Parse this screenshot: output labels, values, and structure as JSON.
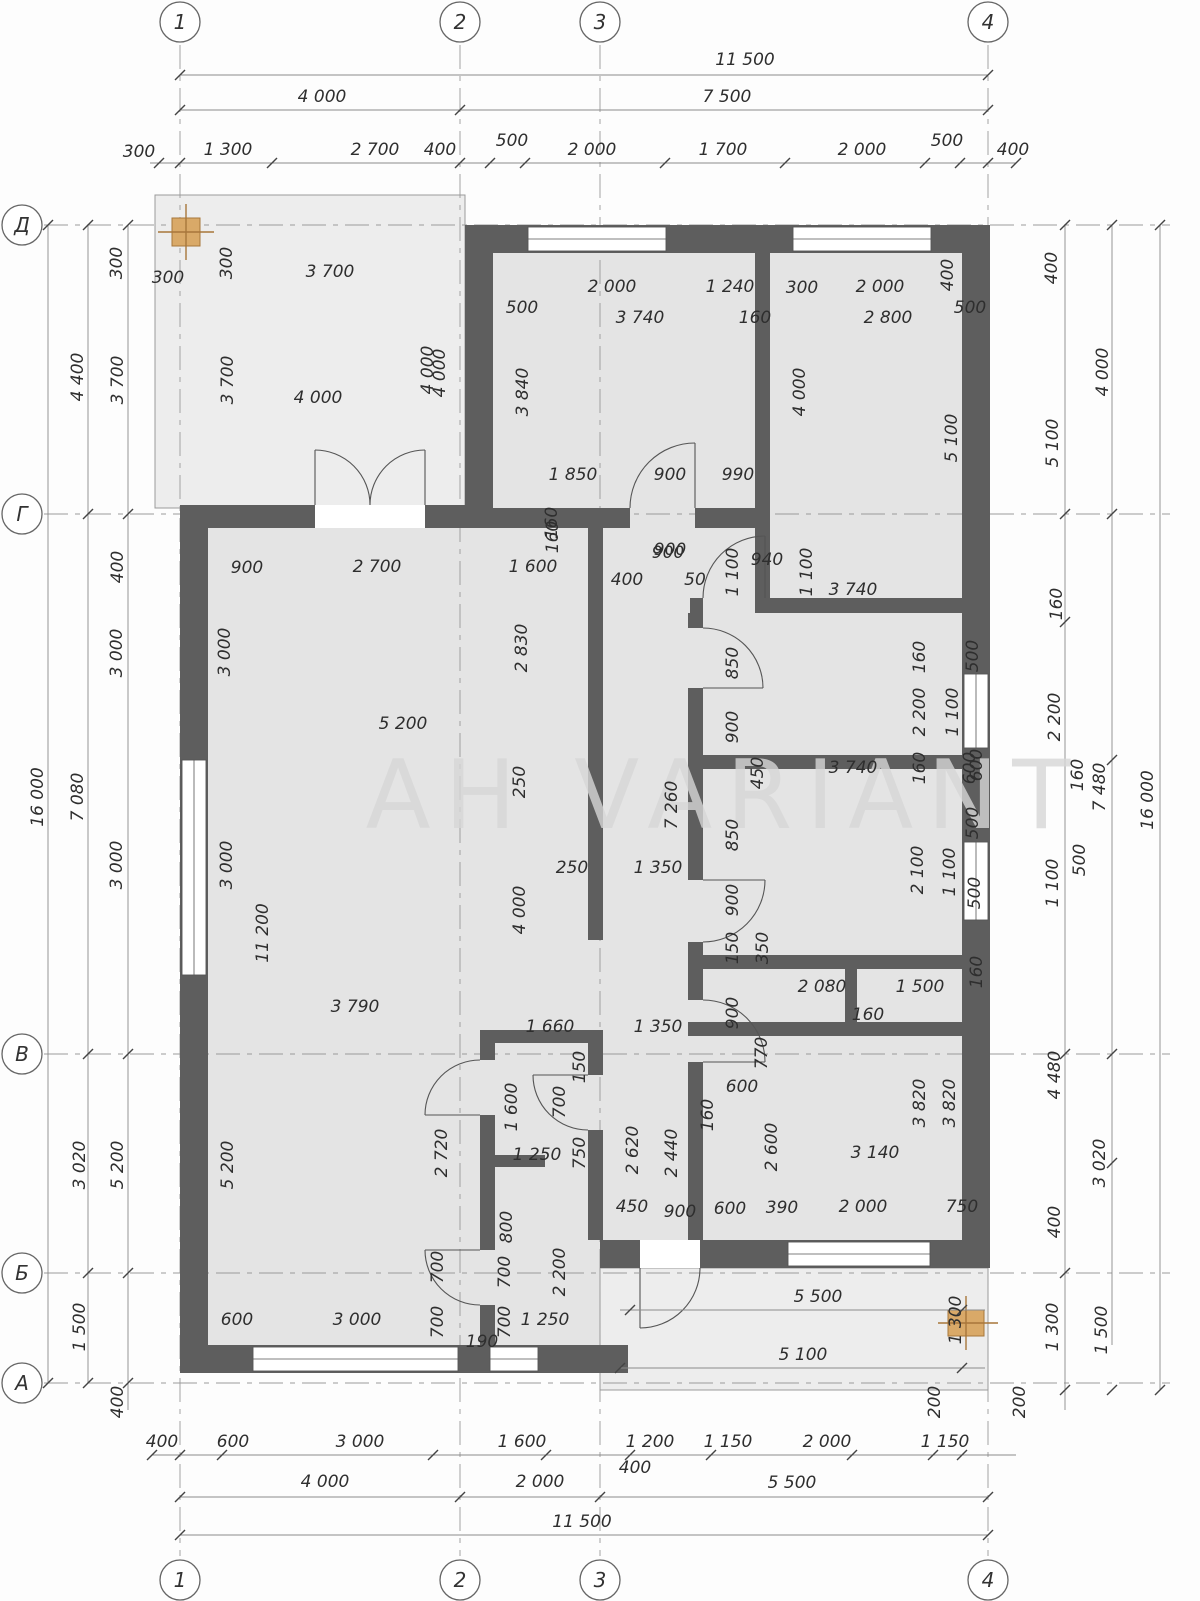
{
  "plan": {
    "watermark": "АН VARIANT",
    "overall": {
      "width_mm": "11 500",
      "height_mm": "16 000"
    },
    "grid_axes": {
      "columns": [
        {
          "label": "1",
          "x": 180
        },
        {
          "label": "2",
          "x": 460
        },
        {
          "label": "3",
          "x": 600
        },
        {
          "label": "4",
          "x": 988
        }
      ],
      "rows": [
        {
          "label": "Д",
          "y": 225
        },
        {
          "label": "Г",
          "y": 514
        },
        {
          "label": "В",
          "y": 1054
        },
        {
          "label": "Б",
          "y": 1273
        },
        {
          "label": "А",
          "y": 1383
        }
      ]
    },
    "dim_labels": [
      [
        745,
        60,
        0,
        "11 500"
      ],
      [
        322,
        97,
        0,
        "4 000"
      ],
      [
        727,
        97,
        0,
        "7 500"
      ],
      [
        139,
        152,
        0,
        "300"
      ],
      [
        228,
        150,
        0,
        "1 300"
      ],
      [
        375,
        150,
        0,
        "2 700"
      ],
      [
        440,
        150,
        0,
        "400"
      ],
      [
        512,
        141,
        0,
        "500"
      ],
      [
        592,
        150,
        0,
        "2 000"
      ],
      [
        723,
        150,
        0,
        "1 700"
      ],
      [
        862,
        150,
        0,
        "2 000"
      ],
      [
        947,
        141,
        0,
        "500"
      ],
      [
        1013,
        150,
        0,
        "400"
      ],
      [
        117,
        263,
        -90,
        "300"
      ],
      [
        168,
        278,
        0,
        "300"
      ],
      [
        227,
        263,
        -90,
        "300"
      ],
      [
        330,
        272,
        0,
        "3 700"
      ],
      [
        78,
        377,
        -90,
        "4 400"
      ],
      [
        118,
        380,
        -90,
        "3 700"
      ],
      [
        228,
        380,
        -90,
        "3 700"
      ],
      [
        318,
        398,
        0,
        "4 000"
      ],
      [
        428,
        370,
        -90,
        "4 000"
      ],
      [
        612,
        287,
        0,
        "2 000"
      ],
      [
        730,
        287,
        0,
        "1 240"
      ],
      [
        522,
        308,
        0,
        "500"
      ],
      [
        640,
        318,
        0,
        "3 740"
      ],
      [
        755,
        318,
        0,
        "160"
      ],
      [
        523,
        392,
        -90,
        "3 840"
      ],
      [
        440,
        373,
        -90,
        "4 000"
      ],
      [
        800,
        392,
        -90,
        "4 000"
      ],
      [
        573,
        475,
        0,
        "1 850"
      ],
      [
        670,
        475,
        0,
        "900"
      ],
      [
        738,
        475,
        0,
        "990"
      ],
      [
        552,
        523,
        -90,
        "160"
      ],
      [
        670,
        550,
        0,
        "900"
      ],
      [
        802,
        288,
        0,
        "300"
      ],
      [
        880,
        287,
        0,
        "2 000"
      ],
      [
        948,
        275,
        -90,
        "400"
      ],
      [
        970,
        308,
        0,
        "500"
      ],
      [
        888,
        318,
        0,
        "2 800"
      ],
      [
        952,
        438,
        -90,
        "5 100"
      ],
      [
        1052,
        268,
        -90,
        "400"
      ],
      [
        1103,
        372,
        -90,
        "4 000"
      ],
      [
        1053,
        443,
        -90,
        "5 100"
      ],
      [
        1057,
        604,
        -90,
        "160"
      ],
      [
        668,
        553,
        0,
        "900"
      ],
      [
        627,
        580,
        0,
        "400"
      ],
      [
        695,
        580,
        0,
        "50"
      ],
      [
        767,
        560,
        0,
        "940"
      ],
      [
        733,
        572,
        -90,
        "1 100"
      ],
      [
        807,
        572,
        -90,
        "1 100"
      ],
      [
        853,
        590,
        0,
        "3 740"
      ],
      [
        733,
        663,
        -90,
        "850"
      ],
      [
        733,
        727,
        -90,
        "900"
      ],
      [
        920,
        657,
        -90,
        "160"
      ],
      [
        920,
        712,
        -90,
        "2 200"
      ],
      [
        953,
        712,
        -90,
        "1 100"
      ],
      [
        973,
        656,
        -90,
        "500"
      ],
      [
        977,
        765,
        -90,
        "600"
      ],
      [
        1055,
        717,
        -90,
        "2 200"
      ],
      [
        1078,
        775,
        -90,
        "160"
      ],
      [
        1100,
        787,
        -90,
        "7 480"
      ],
      [
        1148,
        800,
        -90,
        "16 000"
      ],
      [
        1080,
        860,
        -90,
        "500"
      ],
      [
        1053,
        883,
        -90,
        "1 100"
      ],
      [
        975,
        893,
        -90,
        "500"
      ],
      [
        977,
        972,
        -90,
        "160"
      ],
      [
        1055,
        1075,
        -90,
        "4 480"
      ],
      [
        973,
        823,
        -90,
        "500"
      ],
      [
        853,
        768,
        0,
        "3 740"
      ],
      [
        920,
        768,
        -90,
        "160"
      ],
      [
        970,
        768,
        -90,
        "600"
      ],
      [
        758,
        773,
        -90,
        "450"
      ],
      [
        733,
        835,
        -90,
        "850"
      ],
      [
        733,
        900,
        -90,
        "900"
      ],
      [
        733,
        948,
        -90,
        "150"
      ],
      [
        763,
        948,
        -90,
        "350"
      ],
      [
        918,
        870,
        -90,
        "2 100"
      ],
      [
        950,
        872,
        -90,
        "1 100"
      ],
      [
        822,
        987,
        0,
        "2 080"
      ],
      [
        920,
        987,
        0,
        "1 500"
      ],
      [
        868,
        1015,
        0,
        "160"
      ],
      [
        672,
        805,
        -90,
        "7 260"
      ],
      [
        572,
        868,
        0,
        "250"
      ],
      [
        658,
        868,
        0,
        "1 350"
      ],
      [
        520,
        782,
        -90,
        "250"
      ],
      [
        520,
        910,
        -90,
        "4 000"
      ],
      [
        733,
        1013,
        -90,
        "900"
      ],
      [
        762,
        1053,
        -90,
        "770"
      ],
      [
        247,
        568,
        0,
        "900"
      ],
      [
        377,
        567,
        0,
        "2 700"
      ],
      [
        533,
        567,
        0,
        "1 600"
      ],
      [
        553,
        537,
        -90,
        "160"
      ],
      [
        225,
        652,
        -90,
        "3 000"
      ],
      [
        522,
        648,
        -90,
        "2 830"
      ],
      [
        403,
        724,
        0,
        "5 200"
      ],
      [
        263,
        933,
        -90,
        "11 200"
      ],
      [
        227,
        865,
        -90,
        "3 000"
      ],
      [
        355,
        1007,
        0,
        "3 790"
      ],
      [
        550,
        1027,
        0,
        "1 660"
      ],
      [
        658,
        1027,
        0,
        "1 350"
      ],
      [
        118,
        567,
        -90,
        "400"
      ],
      [
        117,
        653,
        -90,
        "3 000"
      ],
      [
        117,
        865,
        -90,
        "3 000"
      ],
      [
        38,
        797,
        -90,
        "16 000"
      ],
      [
        78,
        797,
        -90,
        "7 080"
      ],
      [
        80,
        1165,
        -90,
        "3 020"
      ],
      [
        118,
        1165,
        -90,
        "5 200"
      ],
      [
        228,
        1165,
        -90,
        "5 200"
      ],
      [
        80,
        1327,
        -90,
        "1 500"
      ],
      [
        118,
        1402,
        -90,
        "400"
      ],
      [
        580,
        1067,
        -90,
        "150"
      ],
      [
        560,
        1102,
        -90,
        "700"
      ],
      [
        512,
        1107,
        -90,
        "1 600"
      ],
      [
        708,
        1115,
        -90,
        "160"
      ],
      [
        442,
        1153,
        -90,
        "2 720"
      ],
      [
        537,
        1155,
        0,
        "1 250"
      ],
      [
        580,
        1153,
        -90,
        "750"
      ],
      [
        633,
        1150,
        -90,
        "2 620"
      ],
      [
        672,
        1153,
        -90,
        "2 440"
      ],
      [
        507,
        1227,
        -90,
        "800"
      ],
      [
        505,
        1272,
        -90,
        "700"
      ],
      [
        560,
        1272,
        -90,
        "2 200"
      ],
      [
        438,
        1267,
        -90,
        "700"
      ],
      [
        438,
        1322,
        -90,
        "700"
      ],
      [
        505,
        1322,
        -90,
        "700"
      ],
      [
        545,
        1320,
        0,
        "1 250"
      ],
      [
        482,
        1342,
        0,
        "190"
      ],
      [
        237,
        1320,
        0,
        "600"
      ],
      [
        357,
        1320,
        0,
        "3 000"
      ],
      [
        632,
        1207,
        0,
        "450"
      ],
      [
        680,
        1212,
        0,
        "900"
      ],
      [
        730,
        1209,
        0,
        "600"
      ],
      [
        782,
        1208,
        0,
        "390"
      ],
      [
        863,
        1207,
        0,
        "2 000"
      ],
      [
        962,
        1207,
        0,
        "750"
      ],
      [
        742,
        1087,
        0,
        "600"
      ],
      [
        772,
        1147,
        -90,
        "2 600"
      ],
      [
        875,
        1153,
        0,
        "3 140"
      ],
      [
        920,
        1103,
        -90,
        "3 820"
      ],
      [
        950,
        1103,
        -90,
        "3 820"
      ],
      [
        818,
        1297,
        0,
        "5 500"
      ],
      [
        803,
        1355,
        0,
        "5 100"
      ],
      [
        956,
        1320,
        -90,
        "1 300"
      ],
      [
        1053,
        1327,
        -90,
        "1 300"
      ],
      [
        1102,
        1330,
        -90,
        "1 500"
      ],
      [
        1100,
        1163,
        -90,
        "3 020"
      ],
      [
        1055,
        1222,
        -90,
        "400"
      ],
      [
        935,
        1402,
        -90,
        "200"
      ],
      [
        1020,
        1402,
        -90,
        "200"
      ],
      [
        162,
        1442,
        0,
        "400"
      ],
      [
        233,
        1442,
        0,
        "600"
      ],
      [
        360,
        1442,
        0,
        "3 000"
      ],
      [
        522,
        1442,
        0,
        "1 600"
      ],
      [
        650,
        1442,
        0,
        "1 200"
      ],
      [
        728,
        1442,
        0,
        "1 150"
      ],
      [
        827,
        1442,
        0,
        "2 000"
      ],
      [
        945,
        1442,
        0,
        "1 150"
      ],
      [
        635,
        1468,
        0,
        "400"
      ],
      [
        325,
        1482,
        0,
        "4 000"
      ],
      [
        540,
        1482,
        0,
        "2 000"
      ],
      [
        792,
        1483,
        0,
        "5 500"
      ],
      [
        582,
        1522,
        0,
        "11 500"
      ]
    ]
  }
}
